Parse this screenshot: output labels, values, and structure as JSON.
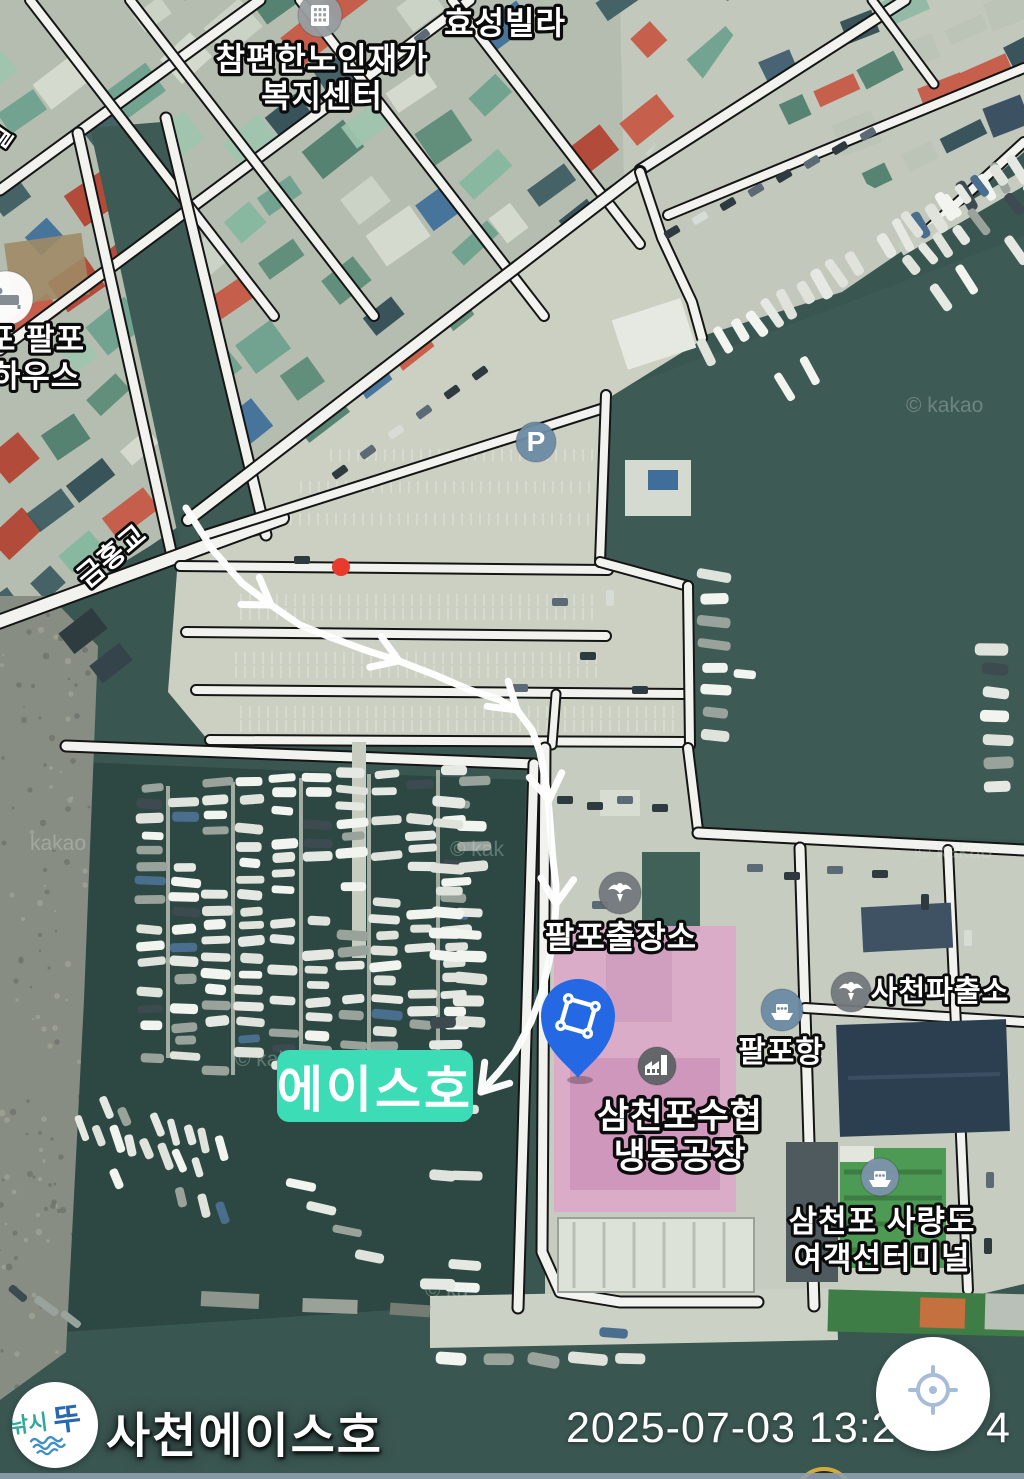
{
  "map": {
    "labels": [
      {
        "name": "label-hyoseong-villa",
        "lines": [
          "효성빌라"
        ],
        "x": 505,
        "y": 34,
        "size": 32
      },
      {
        "name": "label-welfare-center",
        "lines": [
          "참편한노인재가",
          "복지센터"
        ],
        "x": 322,
        "y": 70,
        "size": 32,
        "lh": 37
      },
      {
        "name": "label-palpo-house",
        "lines": [
          "포 팔포",
          "하우스"
        ],
        "x": 36,
        "y": 350,
        "size": 31,
        "lh": 37
      },
      {
        "name": "label-geumhong-bridge",
        "lines": [
          "금홍교"
        ],
        "x": 118,
        "y": 563,
        "size": 28,
        "rotate": -40
      },
      {
        "name": "label-palpo-branch-office",
        "lines": [
          "팔포출장소"
        ],
        "x": 621,
        "y": 948,
        "size": 32
      },
      {
        "name": "label-sacheon-police-box",
        "lines": [
          "사천파출소"
        ],
        "x": 940,
        "y": 1001,
        "size": 29
      },
      {
        "name": "label-palpo-port",
        "lines": [
          "팔포항"
        ],
        "x": 781,
        "y": 1062,
        "size": 30
      },
      {
        "name": "label-freezing-plant",
        "lines": [
          "삼천포수협",
          "냉동공장"
        ],
        "x": 680,
        "y": 1128,
        "size": 35,
        "lh": 40
      },
      {
        "name": "label-ferry-terminal",
        "lines": [
          "삼천포 사량도",
          "여객선터미널"
        ],
        "x": 882,
        "y": 1232,
        "size": 31,
        "lh": 37
      },
      {
        "name": "label-road-partial",
        "lines": [
          "길"
        ],
        "x": 8,
        "y": 142,
        "size": 24,
        "rotate": -55
      }
    ],
    "pois": [
      {
        "name": "welfare-building-icon",
        "glyph": "building",
        "x": 320,
        "y": 15,
        "r": 22,
        "bg": "#989da1",
        "fg": "#ffffff"
      },
      {
        "name": "lodging-icon",
        "glyph": "bed",
        "x": 6,
        "y": 298,
        "r": 27,
        "bg": "#ffffff",
        "fg": "#858d94"
      },
      {
        "name": "parking-icon",
        "glyph": "P",
        "x": 536,
        "y": 442,
        "r": 20,
        "bg": "#6d8ba6",
        "fg": "#ffffff"
      },
      {
        "name": "police-icon",
        "glyph": "police",
        "x": 620,
        "y": 893,
        "r": 21,
        "bg": "#74797e",
        "fg": "#ffffff"
      },
      {
        "name": "police-icon",
        "glyph": "police",
        "x": 851,
        "y": 992,
        "r": 20,
        "bg": "#74797e",
        "fg": "#ffffff"
      },
      {
        "name": "port-ship-icon",
        "glyph": "ship",
        "x": 782,
        "y": 1010,
        "r": 21,
        "bg": "#6d8ba6",
        "fg": "#ffffff"
      },
      {
        "name": "factory-icon",
        "glyph": "factory",
        "x": 657,
        "y": 1066,
        "r": 19,
        "bg": "#5e6367",
        "fg": "#ffffff"
      },
      {
        "name": "ferry-icon",
        "glyph": "ship",
        "x": 880,
        "y": 1177,
        "r": 19,
        "bg": "#7e93ab",
        "fg": "#ffffff"
      }
    ],
    "parking_letter": "P",
    "watermarks": [
      {
        "text": "© kakao",
        "x": 906,
        "y": 412
      },
      {
        "text": "kakao",
        "x": 30,
        "y": 850
      },
      {
        "text": "© kak",
        "x": 450,
        "y": 856
      },
      {
        "text": "© kakao",
        "x": 915,
        "y": 858
      },
      {
        "text": "© kaka",
        "x": 235,
        "y": 1066
      },
      {
        "text": "© ka",
        "x": 425,
        "y": 1297
      }
    ],
    "highlight_tag": {
      "text": "에이스호"
    },
    "route": {
      "points": [
        [
          186,
          508
        ],
        [
          212,
          549
        ],
        [
          242,
          583
        ],
        [
          271,
          605
        ],
        [
          300,
          625
        ],
        [
          330,
          637
        ],
        [
          365,
          650
        ],
        [
          399,
          661
        ],
        [
          435,
          675
        ],
        [
          470,
          690
        ],
        [
          500,
          700
        ],
        [
          517,
          710
        ],
        [
          532,
          730
        ],
        [
          540,
          752
        ],
        [
          547,
          790
        ],
        [
          549,
          810
        ],
        [
          553,
          860
        ],
        [
          556,
          885
        ],
        [
          556,
          904
        ],
        [
          554,
          935
        ],
        [
          549,
          962
        ],
        [
          541,
          995
        ],
        [
          531,
          1022
        ],
        [
          515,
          1052
        ],
        [
          499,
          1072
        ],
        [
          481,
          1092
        ]
      ],
      "arrowheads": [
        {
          "x": 271,
          "y": 605,
          "dir": 34
        },
        {
          "x": 399,
          "y": 661,
          "dir": 21
        },
        {
          "x": 517,
          "y": 710,
          "dir": 40
        },
        {
          "x": 549,
          "y": 800,
          "dir": 82
        },
        {
          "x": 556,
          "y": 904,
          "dir": 93
        },
        {
          "x": 481,
          "y": 1092,
          "dir": 130
        }
      ]
    },
    "red_dot": {
      "x": 341,
      "y": 567
    }
  },
  "colors": {
    "tag_bg": "#3bdcb6",
    "pin_blue": "#2468e4",
    "route_white": "#ffffff",
    "red_dot": "#e83a2d",
    "gold_ring": "#d6ab3e",
    "target_blue": "#a6bcd9",
    "logo_teal": "#2fa89b",
    "logo_blue": "#2968b0",
    "label_fill": "#ffffff",
    "label_stroke": "#0b0b0b",
    "watermark": "rgba(215,232,226,0.30)"
  },
  "footer": {
    "logo_part1": "낚시",
    "logo_part2": "뚜",
    "title": "사천에이스호",
    "timestamp_left": "2025-07-03 13:2",
    "timestamp_right": "4"
  }
}
